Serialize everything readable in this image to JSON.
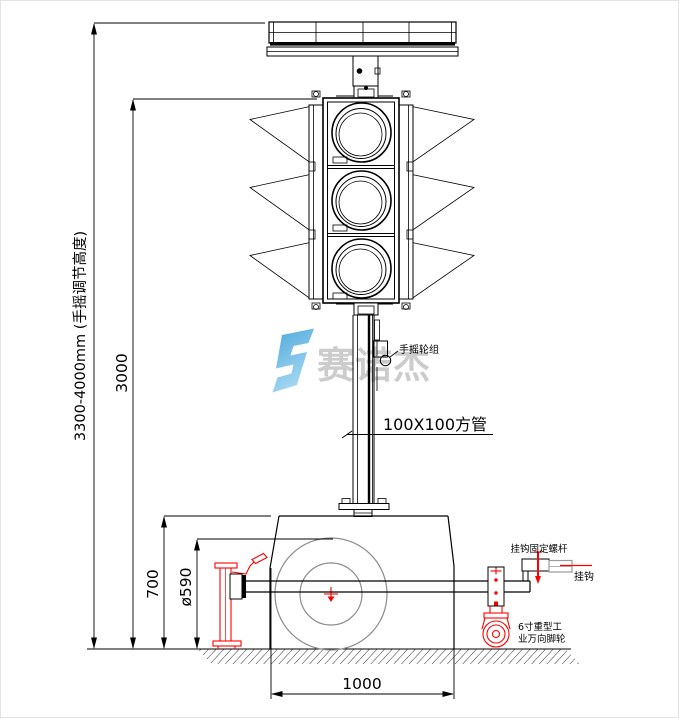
{
  "watermark": {
    "brand_text": "赛诺杰",
    "brand_text_color": "#cccccc",
    "logo_color_top": "#4fa8dc",
    "logo_color_bottom": "#a6d9f2"
  },
  "dimensions": {
    "overall_height_label": "3300-4000mm (手摇调节高度)",
    "mast_height_label": "3000",
    "base_height_label": "700",
    "wheel_diameter_label": "ø590",
    "base_length_label": "1000"
  },
  "callouts": {
    "pole_label": "100X100方管",
    "crank_label": "手摇轮组",
    "hook_bolt_label": "挂钩固定螺杆",
    "hook_label": "挂钩",
    "caster_label_line1": "6寸重型工",
    "caster_label_line2": "业万向脚轮"
  },
  "colors": {
    "line": "#000000",
    "accent_red": "#ff0000",
    "wheel_gray": "#8c8c8c",
    "hook_tube_gray": "#9a9a9a"
  }
}
